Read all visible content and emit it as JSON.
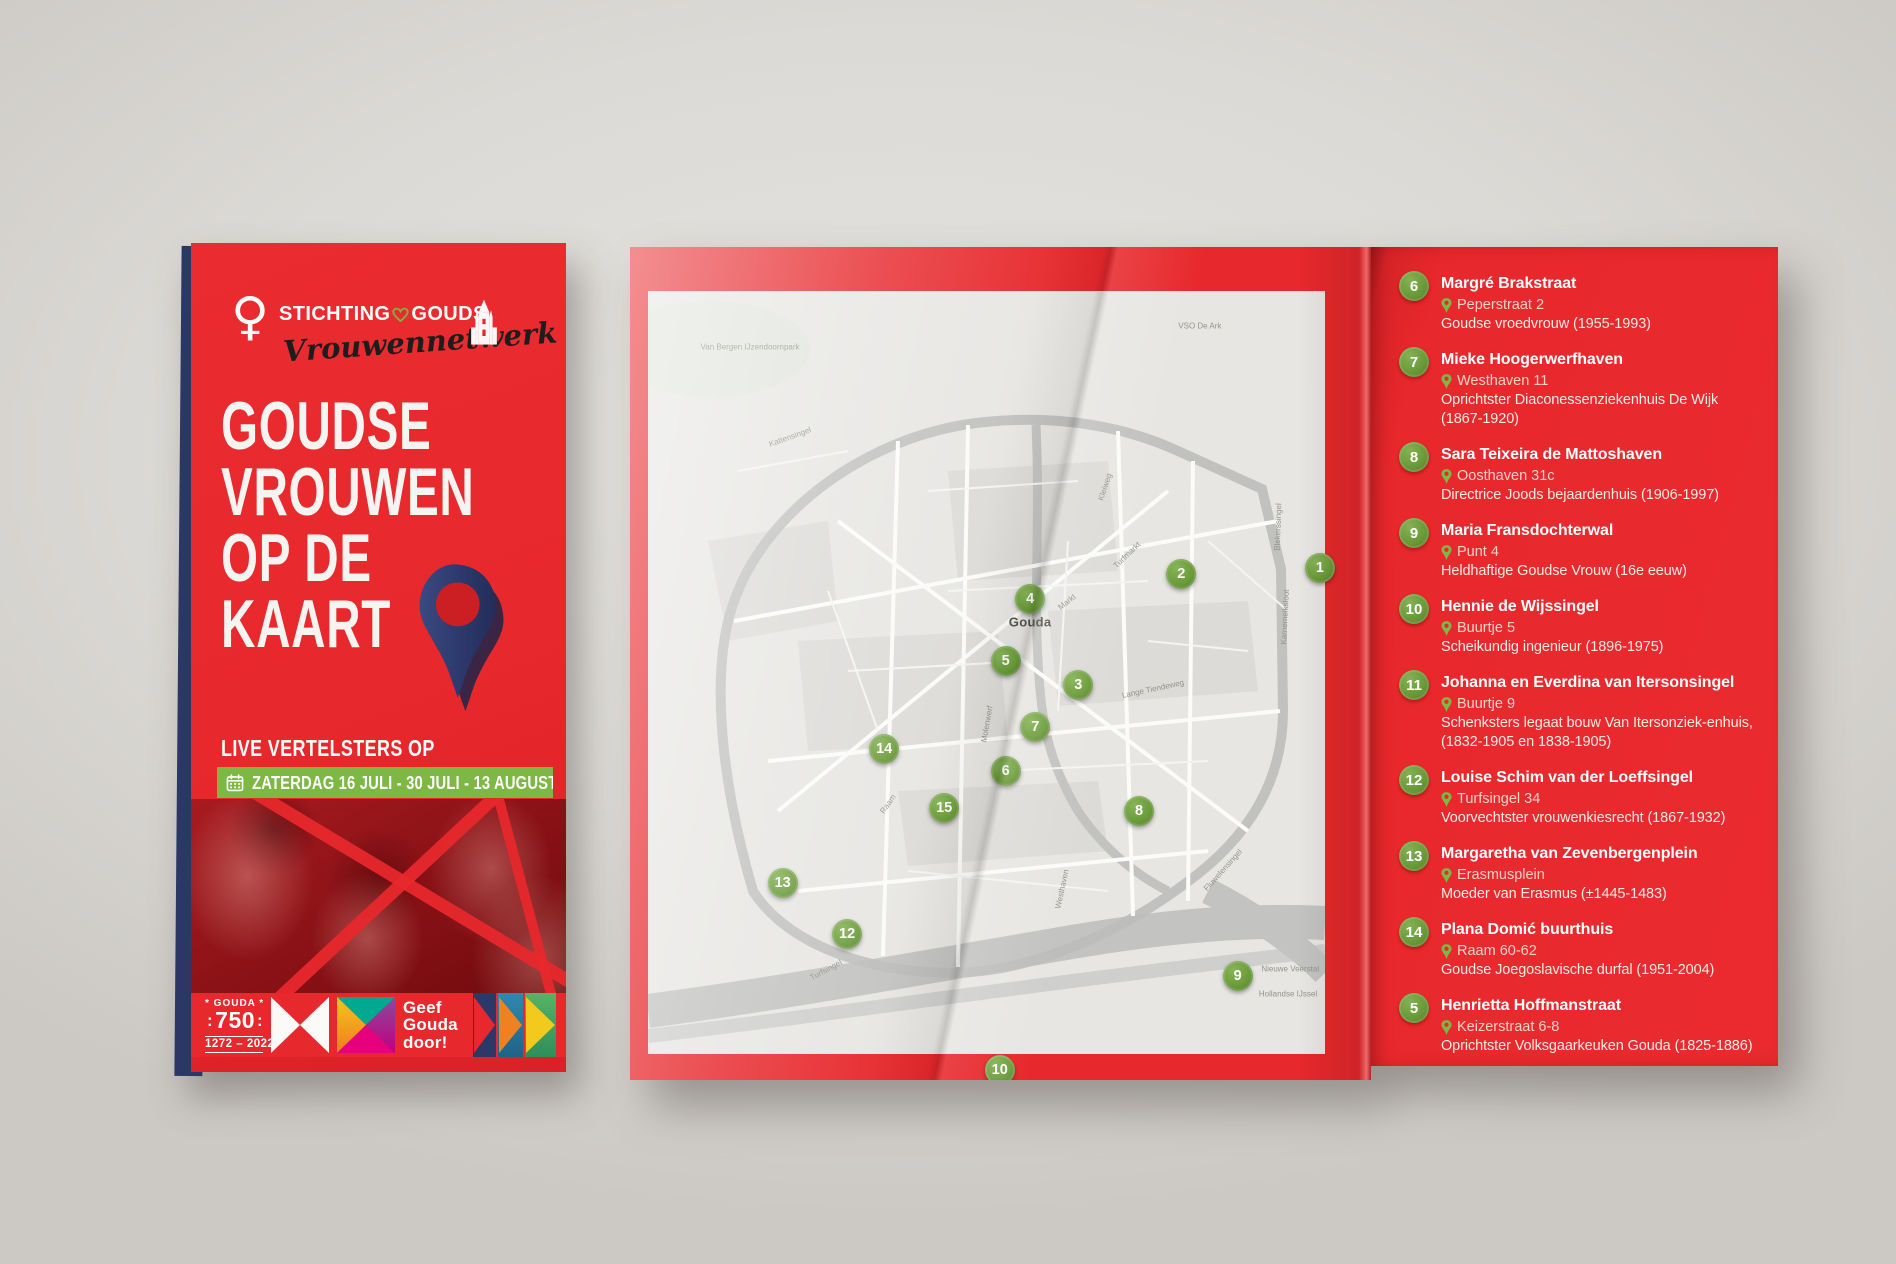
{
  "colors": {
    "brand_red": "#e7282c",
    "navy": "#2b3765",
    "marker_green": "#6b9c3a",
    "banner_green": "#7cb843",
    "heart_green": "#76b643",
    "teal": "#00a98f",
    "magenta": "#e6007e",
    "purple": "#8a4a9e",
    "yellow": "#f6c51e",
    "orange": "#ef7d20"
  },
  "front_cover": {
    "logo": {
      "female_symbol": "♀",
      "org_prefix": "STICHTING",
      "org_suffix": "GOUDS",
      "script": "Vrouwennetwerk"
    },
    "title_lines": [
      "GOUDSE",
      "VROUWEN",
      "OP DE",
      "KAART"
    ],
    "subtitle": "LIVE VERTELSTERS OP",
    "date_banner": "ZATERDAG 16 JULI - 30 JULI - 13 AUGUSTUS",
    "footer": {
      "gouda750_top": "* GOUDA *",
      "gouda750_number": "750",
      "gouda750_years": "1272 – 2022",
      "slogan_lines": [
        "Geef",
        "Gouda",
        "door!"
      ]
    }
  },
  "map_page": {
    "city_label": "Gouda",
    "markers": [
      {
        "number": "1",
        "x": "93.1%",
        "y": "38.5%"
      },
      {
        "number": "2",
        "x": "74.4%",
        "y": "39.2%"
      },
      {
        "number": "3",
        "x": "60.5%",
        "y": "52.6%"
      },
      {
        "number": "4",
        "x": "54.0%",
        "y": "42.3%"
      },
      {
        "number": "5",
        "x": "50.7%",
        "y": "49.7%"
      },
      {
        "number": "6",
        "x": "50.7%",
        "y": "62.9%"
      },
      {
        "number": "7",
        "x": "54.7%",
        "y": "57.6%"
      },
      {
        "number": "8",
        "x": "68.7%",
        "y": "67.7%"
      },
      {
        "number": "9",
        "x": "82.0%",
        "y": "87.5%"
      },
      {
        "number": "10",
        "x": "49.9%",
        "y": "98.8%"
      },
      {
        "number": "12",
        "x": "29.3%",
        "y": "82.5%"
      },
      {
        "number": "13",
        "x": "20.6%",
        "y": "76.3%"
      },
      {
        "number": "14",
        "x": "34.3%",
        "y": "60.3%"
      },
      {
        "number": "15",
        "x": "42.4%",
        "y": "67.3%"
      }
    ],
    "street_labels": [
      {
        "text": "Van Bergen IJzendoornpark",
        "x": "16.2%",
        "y": "12.0%",
        "rot": 0
      },
      {
        "text": "VSO De Ark",
        "x": "76.9%",
        "y": "9.5%",
        "rot": 0
      },
      {
        "text": "Kattensingel",
        "x": "21.6%",
        "y": "22.8%",
        "rot": -20
      },
      {
        "text": "Kleiweg",
        "x": "64.1%",
        "y": "28.8%",
        "rot": -72
      },
      {
        "text": "Blekerssingel",
        "x": "87.4%",
        "y": "33.6%",
        "rot": -88
      },
      {
        "text": "Karnemelksloot",
        "x": "88.4%",
        "y": "44.4%",
        "rot": -87
      },
      {
        "text": "Turfmarkt",
        "x": "67.1%",
        "y": "37.0%",
        "rot": -44
      },
      {
        "text": "Markt",
        "x": "59.0%",
        "y": "42.6%",
        "rot": -38
      },
      {
        "text": "Lange Tiendeweg",
        "x": "70.6%",
        "y": "53.1%",
        "rot": -12
      },
      {
        "text": "Molenwerf",
        "x": "48.2%",
        "y": "57.3%",
        "rot": -80
      },
      {
        "text": "Raam",
        "x": "34.8%",
        "y": "66.9%",
        "rot": -55
      },
      {
        "text": "Westhaven",
        "x": "58.3%",
        "y": "77.1%",
        "rot": -78
      },
      {
        "text": "Fluwelensingel",
        "x": "80.0%",
        "y": "74.8%",
        "rot": -48
      },
      {
        "text": "Turfsingel",
        "x": "26.5%",
        "y": "86.8%",
        "rot": -28
      },
      {
        "text": "Nieuwe Veerstal",
        "x": "89.1%",
        "y": "86.7%",
        "rot": 0
      },
      {
        "text": "Hollandse IJssel",
        "x": "88.8%",
        "y": "89.7%",
        "rot": 0
      }
    ]
  },
  "list_panel": {
    "items": [
      {
        "number": "6",
        "name": "Margré Brakstraat",
        "address": "Peperstraat 2",
        "description": "Goudse vroedvrouw (1955-1993)"
      },
      {
        "number": "7",
        "name": "Mieke Hoogerwerfhaven",
        "address": "Westhaven 11",
        "description": "Oprichtster Diaconessenziekenhuis De Wijk (1867-1920)"
      },
      {
        "number": "8",
        "name": "Sara Teixeira de Mattoshaven",
        "address": "Oosthaven 31c",
        "description": "Directrice Joods bejaardenhuis (1906-1997)"
      },
      {
        "number": "9",
        "name": "Maria Fransdochterwal",
        "address": "Punt 4",
        "description": "Heldhaftige Goudse Vrouw (16e eeuw)"
      },
      {
        "number": "10",
        "name": "Hennie de Wijssingel",
        "address": "Buurtje 5",
        "description": "Scheikundig ingenieur (1896-1975)"
      },
      {
        "number": "11",
        "name": "Johanna en Everdina van Itersonsingel",
        "address": "Buurtje 9",
        "description": "Schenksters legaat bouw Van Itersonziek-enhuis, (1832-1905 en 1838-1905)"
      },
      {
        "number": "12",
        "name": "Louise Schim van der Loeffsingel",
        "address": "Turfsingel 34",
        "description": "Voorvechtster vrouwenkiesrecht (1867-1932)"
      },
      {
        "number": "13",
        "name": "Margaretha van Zevenbergenplein",
        "address": "Erasmusplein",
        "description": "Moeder van Erasmus (±1445-1483)"
      },
      {
        "number": "14",
        "name": "Plana Domić buurthuis",
        "address": "Raam 60-62",
        "description": "Goudse Joegoslavische durfal (1951-2004)"
      },
      {
        "number": "5",
        "name": "Henrietta Hoffmanstraat",
        "address": "Keizerstraat 6-8",
        "description": "Oprichtster Volksgaarkeuken Gouda (1825-1886)"
      }
    ]
  }
}
